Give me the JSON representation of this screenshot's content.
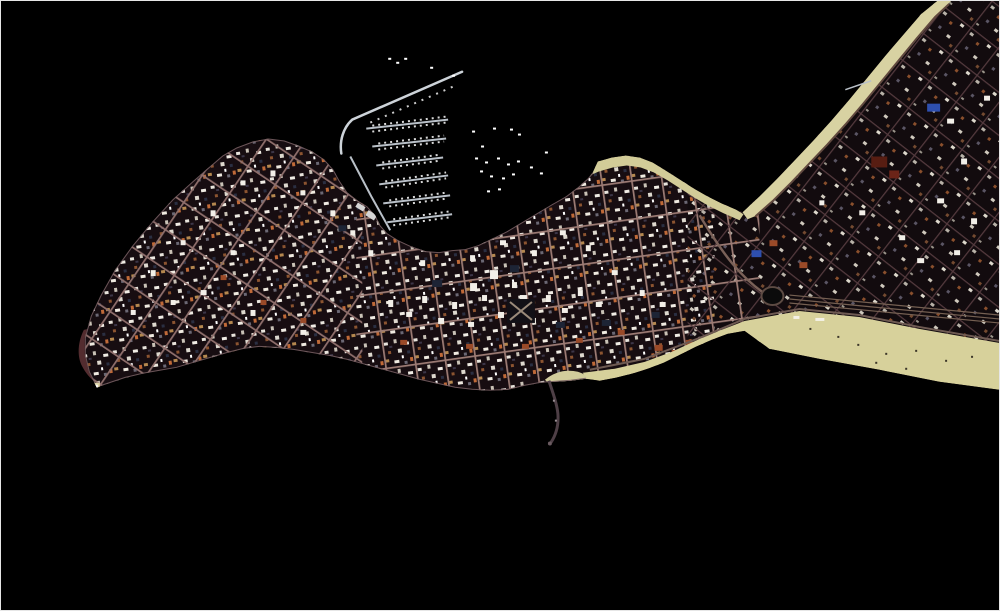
{
  "meta": {
    "type": "satellite-aerial-photograph",
    "subject": "Aerial satellite view of a coastal resort peninsula city jutting into dark water, with a marina harbor of piers and moored boats on the north side, a dense rectangular street grid of city blocks, sandy beaches along the neck and mainland shores, and a narrow rocky spit on the south coast",
    "water_note": "surrounding sea rendered as solid black"
  },
  "colors": {
    "water": "#000000",
    "frame": "#e6e6e6",
    "peninsula_base": "#170d11",
    "mainland_base": "#120b0e",
    "street_west": "#8f6f6c",
    "street_central": "#9c7b74",
    "street_mainland": "#543a3e",
    "coast_road": "#745d60",
    "sand_south_beach": "#d7d19b",
    "sand_northwest_beach": "#d8d2a2",
    "sand_neck_beach": "#d2cc98",
    "sand_point_patch": "#d2cc9c",
    "breakwater": "#cdd3d9",
    "pier": "#b9c0c8",
    "boat": "#ffffff",
    "rocks_west": "#5c3134",
    "spit": "#4e3f46",
    "spit_tip": "#6a5a60",
    "blue_roof": "#2e4fae",
    "white_building": "#f2efe8",
    "navy_roof": "#1d2435",
    "orange_roof": "#9a4a28",
    "dark_red_roof": "#571d12",
    "warehouse": "#d5d5d5",
    "roundabout_fill": "#0b0b0b",
    "roundabout_ring": "#5d4b43",
    "beach_road": "#6e5a52",
    "neck_road": "#7a6158",
    "mainland_road": "#61493f",
    "beach_debris": "#3c3628",
    "beach_structure": "#f4f1e6",
    "plaza_path": "#9a8a7a"
  },
  "features": {
    "peninsula": "peninsula city street grid",
    "mainland": "mainland city area (upper right)",
    "harbor": "black harbor water with anchorage",
    "breakwater": "curved harbor breakwater",
    "marina": "marina with six finger piers and moored boats",
    "anchorage": "scattered boats at anchor in the harbor",
    "south_beach": "wide sandy beach curving along the southeast shore",
    "northwest_beach": "narrow sand strip along mainland northwest shore",
    "neck_beach": "sand strip along the peninsula neck north shore",
    "point_patch": "small sand patch at the south point",
    "south_spit": "narrow rocky spit extending south into the water",
    "lighthouse_point": "pale point at the west tip of the peninsula",
    "rocks_west": "reddish tidal rocks along the west shore",
    "roundabout": "dark traffic circle near the neck",
    "mainland_pier": "small pier off the mainland northwest shore"
  }
}
